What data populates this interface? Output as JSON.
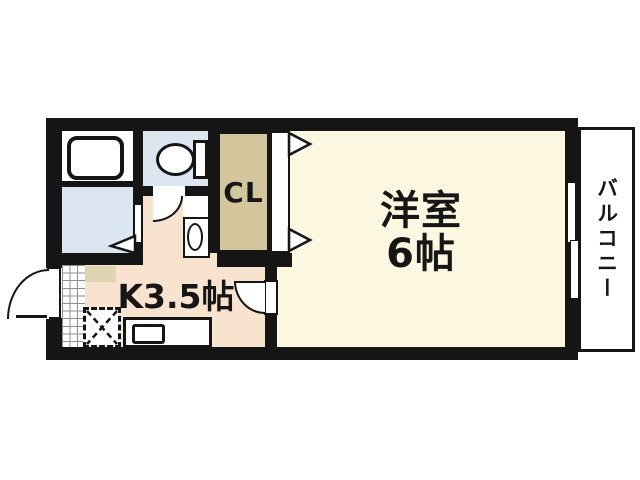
{
  "floorplan": {
    "rooms": {
      "western_room": {
        "name_line1": "洋室",
        "name_line2": "6帖"
      },
      "kitchen": {
        "label": "K3.5帖"
      },
      "closet": {
        "label": "CL"
      },
      "balcony": {
        "label": "バルコニー"
      }
    },
    "fixtures": [
      "bathtub",
      "toilet",
      "washbasin",
      "kitchen-sink",
      "refrigerator-space",
      "entrance-door",
      "tiled-entrance",
      "shoe-cabinet",
      "sliding-window",
      "toilet-door",
      "kitchen-door",
      "washroom-door",
      "closet-doors"
    ],
    "colors": {
      "background": "#FFFFFF",
      "wall": "#151515",
      "western_room_floor": "#FBF7E1",
      "kitchen_floor": "#F8E3CE",
      "closet_fill": "#D4C69C",
      "wet_area_fill": "#DBE6F1",
      "cabinet_fill": "#DFD5B2",
      "fixture_fill": "#FFFFFF",
      "tile_line": "#8F8F8F"
    }
  }
}
